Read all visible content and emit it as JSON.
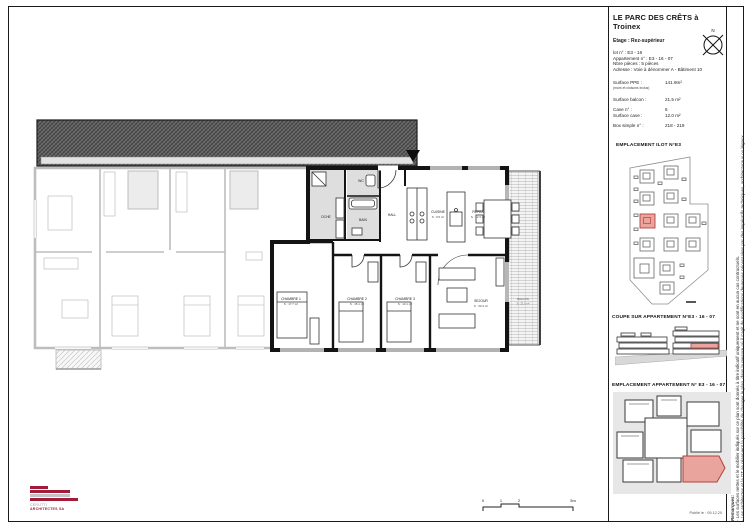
{
  "title_block": {
    "title": "LE PARC DES CRÊTS à Troinex",
    "etage": "Etage : Rez-supérieur",
    "lot": "lot n° : E3 - 16",
    "appartement": "Appartement n° : E3 - 16 - 07",
    "pieces": "Nbre pièces : 5 pièces",
    "adresse": "Adresse : Voie à dénommer A - Bâtiment 10",
    "surface_ppe_label": "Surface PPE :",
    "surface_ppe_value": "141.9m²",
    "surface_ppe_note": "(murs et cloisons inclus)",
    "surface_balcon_label": "Surface balcon :",
    "surface_balcon_value": "21.5 m²",
    "cave_label": "Cave n° :",
    "cave_value": "6",
    "surface_cave_label": "Surface cave :",
    "surface_cave_value": "12.0 m²",
    "box_label": "Box simple n° :",
    "box_value": "218 - 219",
    "compass_n": "N"
  },
  "sections": {
    "ilot_title": "EMPLACEMENT ILOT N°E3",
    "coupe_title": "COUPE SUR APPARTEMENT N°E3 - 16 - 07",
    "emplacement_title": "EMPLACEMENT APPARTEMENT N° E3 - 16 - 07"
  },
  "plan": {
    "rooms": {
      "dche": {
        "name": "DCHE"
      },
      "wc": {
        "name": "WC"
      },
      "bain": {
        "name": "BAIN"
      },
      "hall": {
        "name": "HALL"
      },
      "cuisine": {
        "name": "CUISINE",
        "surface": "S : 9.5 m²"
      },
      "repas": {
        "name": "REPAS",
        "surface": "S : 12.3 m²"
      },
      "chambre1": {
        "name": "CHAMBRE 1",
        "surface": "S : 17.7 m²"
      },
      "chambre2": {
        "name": "CHAMBRE 2",
        "surface": "S : 15.1 m²"
      },
      "chambre3": {
        "name": "CHAMBRE 3",
        "surface": "S : 13.1 m²"
      },
      "sejour": {
        "name": "SEJOUR",
        "surface": "S : 30.3 m²"
      },
      "balcon": {
        "name": "BALCON",
        "surface": "S : 21.5 m²"
      }
    }
  },
  "scalebar": {
    "t0": "0",
    "t1": "1",
    "t2": "2",
    "t5": "5m"
  },
  "logo": {
    "line1": "CERUTTI",
    "line2": "ARCHITECTES SA"
  },
  "footer": {
    "date": "Publié le : 09.12.20"
  },
  "disclaimer": {
    "heading": "Remarques:",
    "line1": "- Les surfaces nettes et le mobilier indiqués sur ce plan sont donnés à titre indicatif uniquement et ne sont en aucun cas contractuels.",
    "line2": "- Les architectes et la DT se réservent la possibilité de changer le plan, dans la mesure où il s'agit de modifications devenues nécessaires par des impératifs techniques, architecturaux ou légaux."
  },
  "colors": {
    "highlight_fill": "#e9a49e",
    "highlight_stroke": "#b5413a",
    "logo_maroon": "#a21c3a",
    "inactive_gray": "#bdbdbd"
  }
}
